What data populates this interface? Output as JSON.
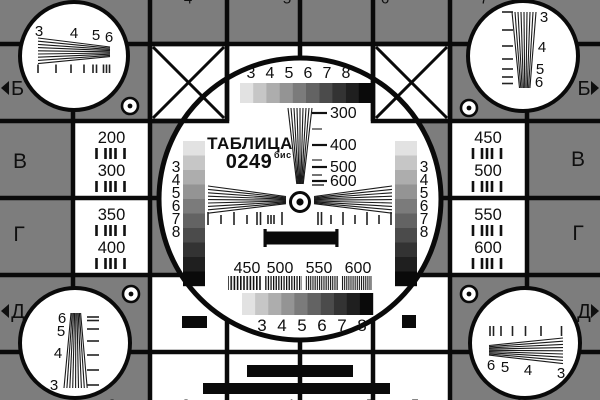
{
  "card": {
    "background_gray": "#7d7d7d",
    "ink": "#0a0a0a",
    "paper": "#ffffff",
    "grayscale_steps": [
      "#e2e2e2",
      "#c6c6c6",
      "#adadad",
      "#949494",
      "#7b7b7b",
      "#636363",
      "#4b4b4b",
      "#333333",
      "#1f1f1f",
      "#0a0a0a"
    ],
    "title": {
      "name": "ТАБЛИЦА",
      "code": "0249",
      "code_suffix": "бис"
    },
    "center": {
      "top_scale": [
        "3",
        "4",
        "5",
        "6",
        "7",
        "8"
      ],
      "wedge_marks": [
        "300",
        "400",
        "500",
        "600"
      ],
      "side_scale": [
        "3",
        "4",
        "5",
        "6",
        "7",
        "8"
      ],
      "burst_labels": [
        "450",
        "500",
        "550",
        "600"
      ],
      "bottom_scale": [
        "3",
        "4",
        "5",
        "6",
        "7",
        "8"
      ]
    },
    "left_panel": {
      "rows": [
        "200",
        "300",
        "350",
        "400"
      ]
    },
    "right_panel": {
      "rows": [
        "450",
        "500",
        "550",
        "600"
      ]
    },
    "rows": {
      "left": [
        "Б",
        "В",
        "Г",
        "Д"
      ],
      "right": [
        "Б",
        "В",
        "Г",
        "Д"
      ]
    },
    "corners": {
      "top_left": [
        "3",
        "4",
        "5",
        "6"
      ],
      "top_right": [
        "3",
        "4",
        "5",
        "6"
      ],
      "bottom_left": [
        "6",
        "5",
        "4",
        "3"
      ],
      "bottom_right": [
        "6",
        "5",
        "4",
        "3"
      ]
    },
    "edge_stubs": {
      "top": [
        "4",
        "5",
        "6",
        "7"
      ],
      "bottom": [
        "2",
        "3",
        "4",
        "5",
        "5",
        "6"
      ]
    }
  }
}
